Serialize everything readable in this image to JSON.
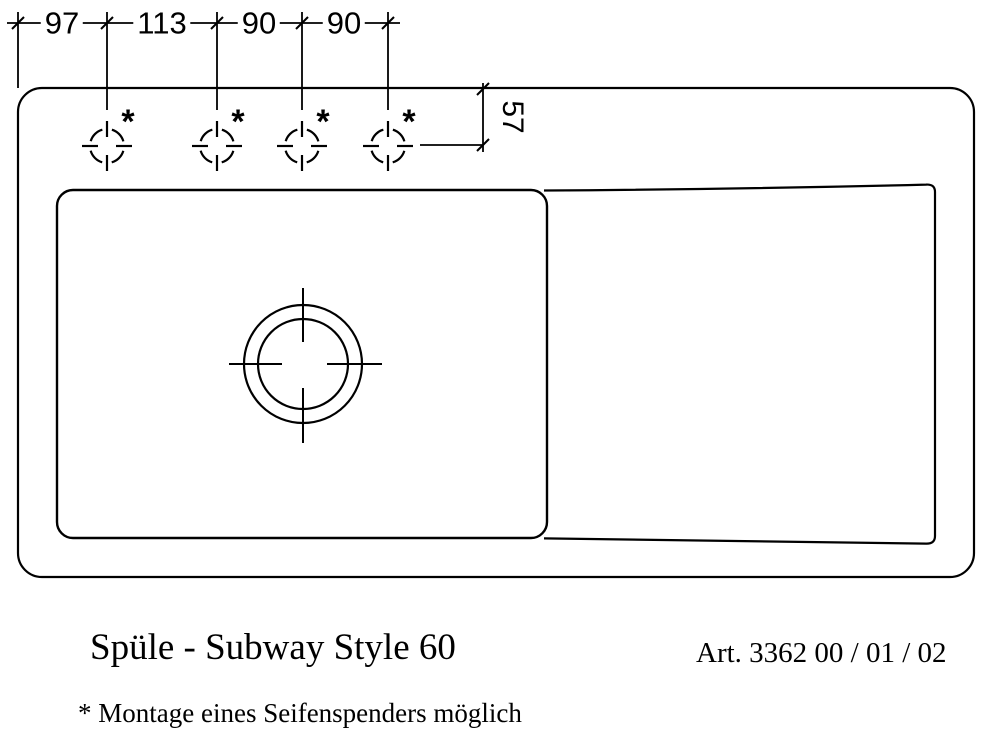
{
  "colors": {
    "line": "#000000",
    "background": "#ffffff"
  },
  "drawing": {
    "top_dimension_chain": [
      "97",
      "113",
      "90",
      "90"
    ],
    "depth_dimension": "57",
    "footnote_marker": "*"
  },
  "caption": {
    "title": "Spüle - Subway Style 60",
    "article_number": "Art. 3362 00 / 01 / 02",
    "footnote": "* Montage eines Seifenspenders möglich"
  }
}
